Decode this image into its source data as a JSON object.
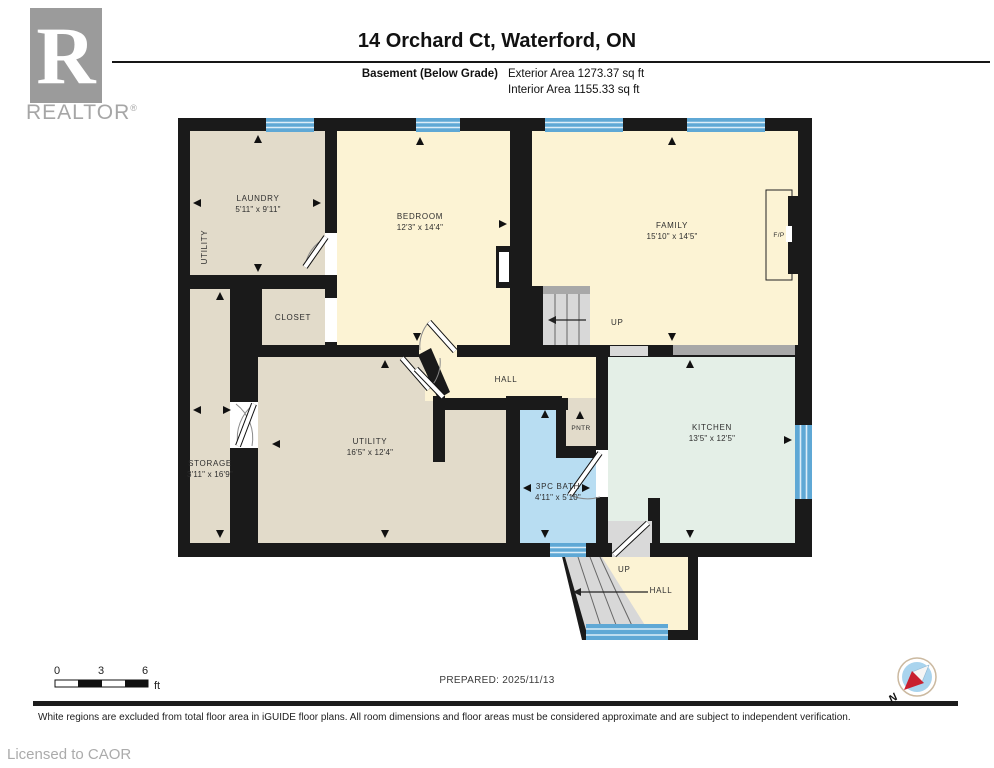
{
  "header": {
    "logo_letter": "R",
    "logo_brand": "REALTOR",
    "logo_reg": "®",
    "title": "14 Orchard Ct, Waterford, ON",
    "floor_label": "Basement (Below Grade)",
    "exterior_area": "Exterior Area 1273.37 sq ft",
    "interior_area": "Interior Area 1155.33 sq ft"
  },
  "rooms": {
    "laundry": {
      "name": "LAUNDRY",
      "dims": "5'11\" x 9'11\""
    },
    "utility_nook": {
      "name": "UTILITY"
    },
    "bedroom": {
      "name": "BEDROOM",
      "dims": "12'3\" x 14'4\""
    },
    "family": {
      "name": "FAMILY",
      "dims": "15'10\" x 14'5\""
    },
    "closet": {
      "name": "CLOSET"
    },
    "storage": {
      "name": "STORAGE",
      "dims": "3'11\" x 16'9\""
    },
    "utility": {
      "name": "UTILITY",
      "dims": "16'5\" x 12'4\""
    },
    "hall": {
      "name": "HALL"
    },
    "pantry": {
      "name": "PNTR"
    },
    "bath": {
      "name": "3PC BATH",
      "dims": "4'11\" x 5'10\""
    },
    "kitchen": {
      "name": "KITCHEN",
      "dims": "13'5\" x 12'5\""
    },
    "hall_lower": {
      "name": "HALL"
    }
  },
  "annotations": {
    "up_main": "UP",
    "up_lower": "UP",
    "fireplace": "F/P"
  },
  "scale_bar": {
    "ticks": [
      "0",
      "3",
      "6"
    ],
    "unit": "ft"
  },
  "footer": {
    "prepared": "PREPARED: 2025/11/13",
    "disclaimer": "White regions are excluded from total floor area in iGUIDE floor plans. All room dimensions and floor areas must be considered approximate and are subject to independent verification.",
    "license": "Licensed to CAOR",
    "compass_n": "N"
  },
  "colors": {
    "wall": "#1a1a1a",
    "floor_beige": "#e2dbca",
    "floor_yellow": "#fcf3d4",
    "floor_mint": "#e4efe7",
    "floor_blue": "#b8ddf2",
    "window_blue": "#5fa8d5",
    "stairs_gray": "#d8d8d8",
    "compass_red": "#c8202f"
  }
}
